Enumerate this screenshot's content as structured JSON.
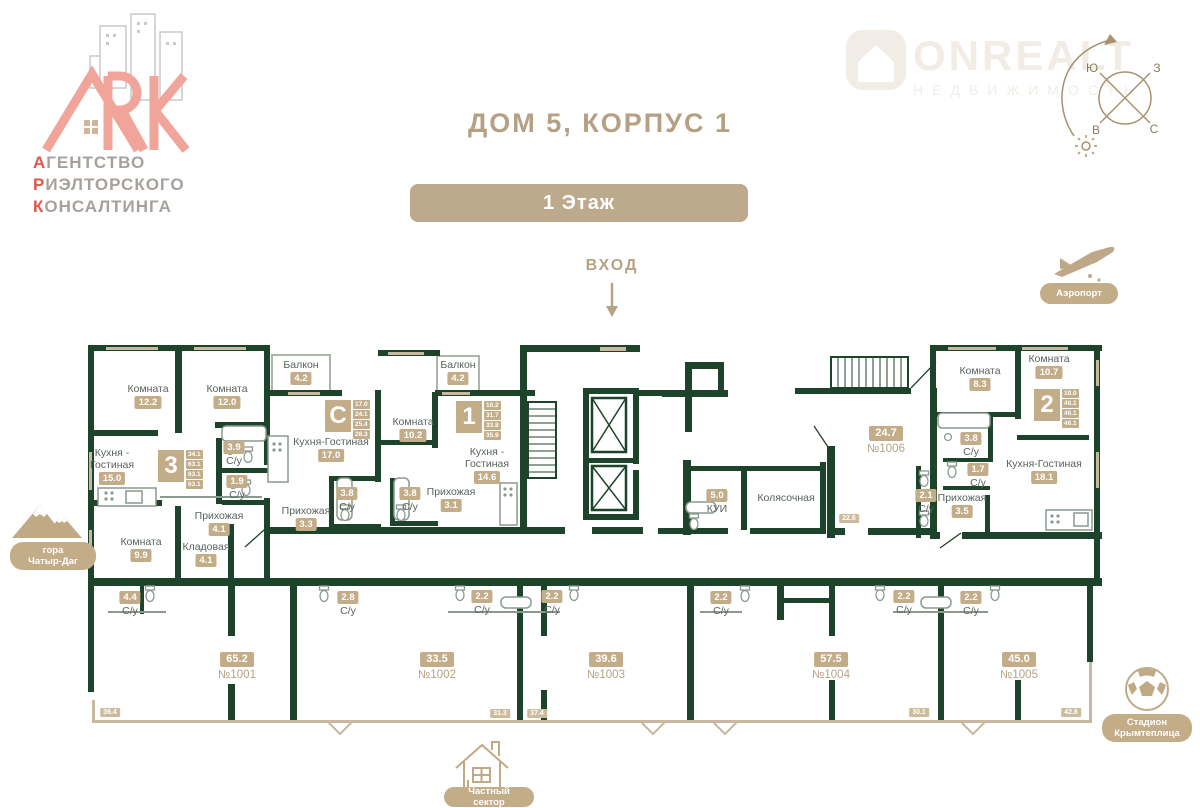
{
  "header": {
    "title": "ДОМ 5, КОРПУС 1",
    "floor_badge": "1 Этаж"
  },
  "brand": {
    "ark_logo": {
      "lines": [
        {
          "first": "А",
          "rest": "ГЕНТСТВО"
        },
        {
          "first": "Р",
          "rest": "ИЭЛТОРСКОГО"
        },
        {
          "first": "К",
          "rest": "ОНСАЛТИНГА"
        }
      ]
    },
    "watermark": {
      "name": "ONREALT",
      "sub": "НЕДВИЖИМОСТЬ"
    }
  },
  "entrance": {
    "label": "ВХОД",
    "arrow": "down"
  },
  "compass": {
    "top_left": "Ю",
    "top_right": "З",
    "bottom_left": "В",
    "bottom_right": "С",
    "icons": [
      "rotation-arrow",
      "sun-icon"
    ]
  },
  "landmarks": {
    "mountain": {
      "icon": "mountains-icon",
      "label": "гора\nЧатыр-Даг"
    },
    "airport": {
      "icon": "airplane-takeoff-icon",
      "label": "Аэропорт"
    },
    "stadium": {
      "icon": "soccer-ball-icon",
      "label": "Стадион\nКрымтеплица"
    },
    "private_sector": {
      "icon": "house-icon",
      "label": "Частный сектор"
    }
  },
  "apartments": [
    {
      "type": "3",
      "areas": [
        "34.1",
        "63.1",
        "63.1",
        "63.1"
      ]
    },
    {
      "type": "С",
      "areas": [
        "17.0",
        "24.1",
        "25.4",
        "28.3"
      ]
    },
    {
      "type": "1",
      "areas": [
        "10.2",
        "31.7",
        "33.8",
        "35.9"
      ]
    },
    {
      "type": "2",
      "areas": [
        "19.0",
        "46.1",
        "46.1",
        "46.1"
      ]
    }
  ],
  "rooms": [
    {
      "name": "Комната",
      "area": "12.2"
    },
    {
      "name": "Комната",
      "area": "12.0"
    },
    {
      "name": "Кухня -\nГостиная",
      "area": "15.0"
    },
    {
      "name": "С/у",
      "area": "3.9"
    },
    {
      "name": "С/у",
      "area": "1.9"
    },
    {
      "name": "Прихожая",
      "area": "4.1"
    },
    {
      "name": "Комната",
      "area": "9.9"
    },
    {
      "name": "Кладовая",
      "area": "4.1"
    },
    {
      "name": "Балкон",
      "area": "4.2"
    },
    {
      "name": "Кухня-Гостиная",
      "area": "17.0"
    },
    {
      "name": "С/у",
      "area": "3.8"
    },
    {
      "name": "Прихожая",
      "area": "3.3"
    },
    {
      "name": "Балкон",
      "area": "4.2"
    },
    {
      "name": "Комната",
      "area": "10.2"
    },
    {
      "name": "С/у",
      "area": "3.8"
    },
    {
      "name": "Кухня -\nГостиная",
      "area": "14.6"
    },
    {
      "name": "Прихожая",
      "area": "3.1"
    },
    {
      "name": "КУИ",
      "area": "5.0"
    },
    {
      "name": "Колясочная"
    },
    {
      "name": "С/у",
      "area": "2.1"
    },
    {
      "name": "Комната",
      "area": "8.3"
    },
    {
      "name": "Комната",
      "area": "10.7"
    },
    {
      "name": "С/у",
      "area": "3.8"
    },
    {
      "name": "С/у",
      "area": "1.7"
    },
    {
      "name": "Прихожая",
      "area": "3.5"
    },
    {
      "name": "Кухня-Гостиная",
      "area": "18.1"
    },
    {
      "name": "С/у",
      "area": "4.4"
    },
    {
      "name": "С/у",
      "area": "2.8"
    },
    {
      "name": "С/у",
      "area": "2.2"
    },
    {
      "name": "С/у",
      "area": "2.2"
    },
    {
      "name": "С/у",
      "area": "2.2"
    },
    {
      "name": "С/у",
      "area": "2.2"
    },
    {
      "name": "С/у",
      "area": "2.2"
    }
  ],
  "units": [
    {
      "area": "65.2",
      "number": "№1001"
    },
    {
      "area": "33.5",
      "number": "№1002"
    },
    {
      "area": "39.6",
      "number": "№1003"
    },
    {
      "area": "57.5",
      "number": "№1004"
    },
    {
      "area": "45.0",
      "number": "№1005"
    },
    {
      "area": "24.7",
      "number": "№1006"
    }
  ],
  "area_tags": [
    "22.6",
    "36.4",
    "31.3",
    "37.4",
    "30.1",
    "42.8"
  ],
  "colors": {
    "wall": "#1d432a",
    "accent_tan": "#c3ac88",
    "title_tan": "#b5a084",
    "logo_red": "#e2564a",
    "logo_salmon": "#f0a49a"
  }
}
